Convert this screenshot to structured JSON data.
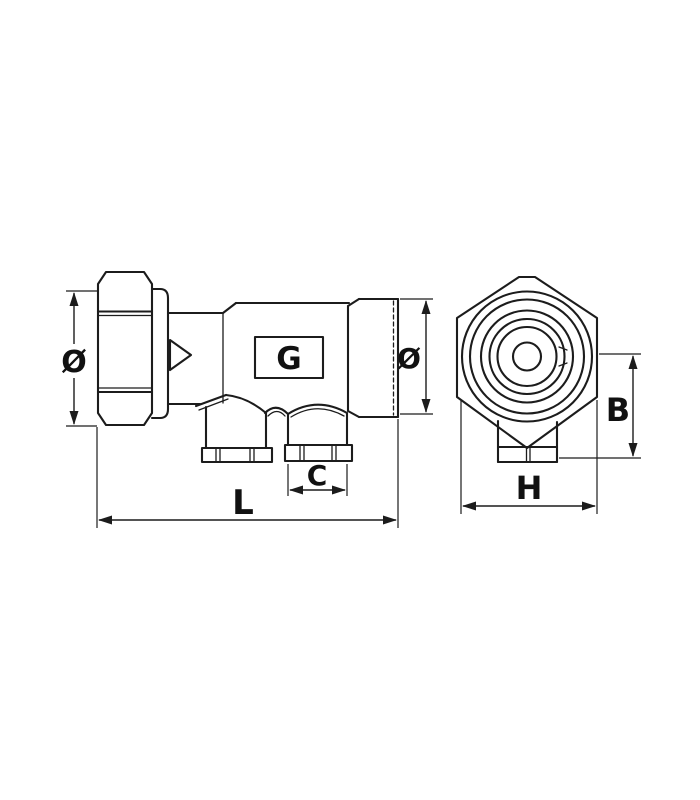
{
  "page": {
    "background": "#ffffff"
  },
  "drawing": {
    "description": "Two-view technical line drawing of a valve fitting with union nut, two bottom outlet ports and hexagonal body",
    "line_color": "#1c1c1c",
    "labels": {
      "nut_diameter": "Ø",
      "pipe_diameter": "Ø",
      "overall_length": "L",
      "outlet_size": "C",
      "body_height": "B",
      "body_width": "H"
    },
    "logo": {
      "letter": "G"
    }
  }
}
